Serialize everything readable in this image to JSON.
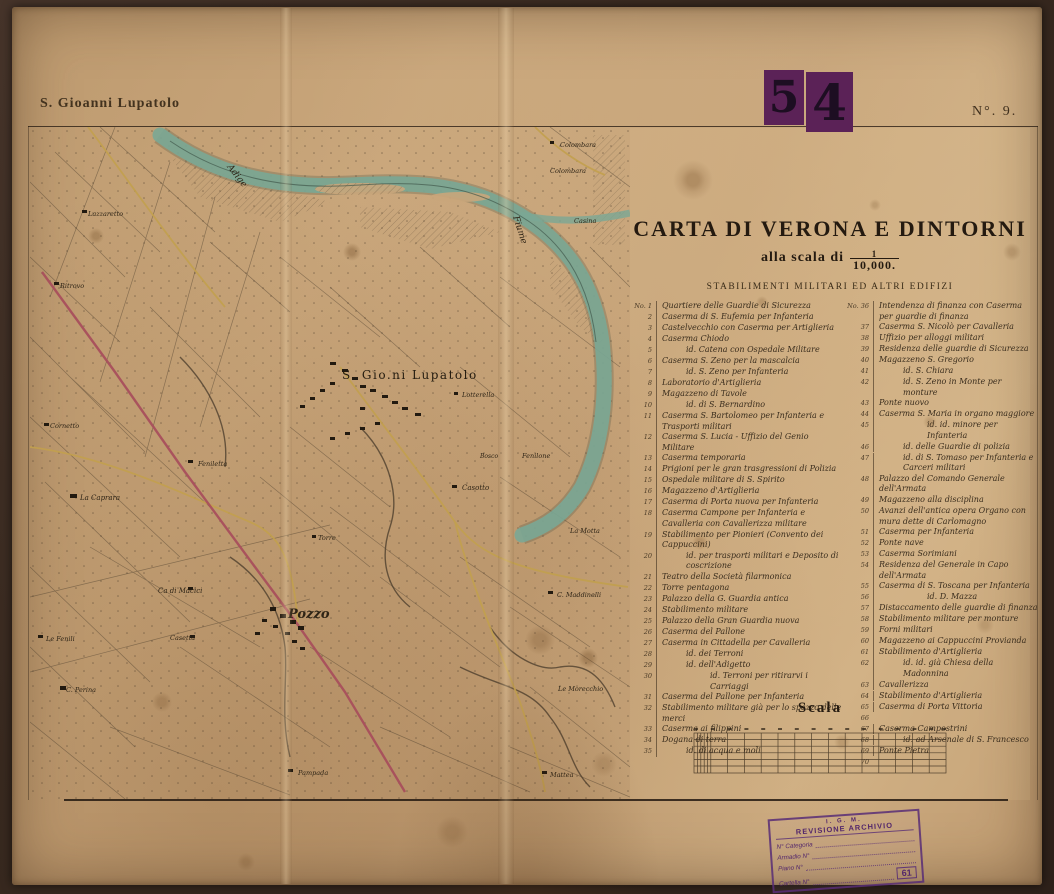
{
  "sheet": {
    "margin_title": "S. Gioanni Lupatolo",
    "sheet_number_left_digit": "5",
    "sheet_number_right_digit": "4",
    "sheet_no": "N°. 9."
  },
  "title_block": {
    "title": "CARTA DI VERONA E DINTORNI",
    "scale_prefix": "alla scala di",
    "scale_num": "1",
    "scale_den": "10,000.",
    "subtitle": "STABILIMENTI MILITARI ED ALTRI EDIFIZI"
  },
  "legend": {
    "left": [
      {
        "n": "No. 1",
        "t": "Quartiere delle Guardie di Sicurezza"
      },
      {
        "n": "2",
        "t": "Caserma di S. Eufemia per Infanteria"
      },
      {
        "n": "3",
        "t": "Castelvecchio con Caserma per Artiglieria"
      },
      {
        "n": "4",
        "t": "Caserma Chiodo"
      },
      {
        "n": "5",
        "t": "id. Catena con Ospedale Militare",
        "ind": 1
      },
      {
        "n": "6",
        "t": "Caserma S. Zeno per la mascalcia"
      },
      {
        "n": "7",
        "t": "id. S. Zeno per Infanteria",
        "ind": 1
      },
      {
        "n": "8",
        "t": "Laboratorio d'Artiglieria"
      },
      {
        "n": "9",
        "t": "Magazzeno di Tavole"
      },
      {
        "n": "10",
        "t": "id. di S. Bernardino",
        "ind": 1
      },
      {
        "n": "11",
        "t": "Caserma S. Bartolomeo per Infanteria e Trasporti militari"
      },
      {
        "n": "12",
        "t": "Caserma S. Lucia - Uffizio del Genio Militare"
      },
      {
        "n": "13",
        "t": "Caserma temporaria"
      },
      {
        "n": "14",
        "t": "Prigioni per le gran trasgressioni di Polizia"
      },
      {
        "n": "15",
        "t": "Ospedale militare di S. Spirito"
      },
      {
        "n": "16",
        "t": "Magazzeno d'Artiglieria"
      },
      {
        "n": "17",
        "t": "Caserma di Porta nuova per Infanteria"
      },
      {
        "n": "18",
        "t": "Caserma Campone per Infanteria e Cavalleria con Cavallerizza militare"
      },
      {
        "n": "19",
        "t": "Stabilimento per Pionieri (Convento dei Cappuccini)"
      },
      {
        "n": "20",
        "t": "id. per trasporti militari e Deposito di coscrizione",
        "ind": 1
      },
      {
        "n": "21",
        "t": "Teatro della Società filarmonica"
      },
      {
        "n": "22",
        "t": "Torre pentagona"
      },
      {
        "n": "23",
        "t": "Palazzo della G. Guardia antica"
      },
      {
        "n": "24",
        "t": "Stabilimento militare"
      },
      {
        "n": "25",
        "t": "Palazzo della Gran Guardia nuova"
      },
      {
        "n": "26",
        "t": "Caserma del Pallone"
      },
      {
        "n": "27",
        "t": "Caserma in Cittadella per Cavalleria"
      },
      {
        "n": "28",
        "t": "id. dei Terroni",
        "ind": 1
      },
      {
        "n": "29",
        "t": "id. dell'Adigetto",
        "ind": 1
      },
      {
        "n": "30",
        "t": "id. Terroni per ritirarvi i Carriaggi",
        "ind": 2
      },
      {
        "n": "31",
        "t": "Caserma del Pallone per Infanteria"
      },
      {
        "n": "32",
        "t": "Stabilimento militare già per lo spazzo delle merci"
      },
      {
        "n": "33",
        "t": "Caserma ai filippini"
      },
      {
        "n": "34",
        "t": "Dogana di terra"
      },
      {
        "n": "35",
        "t": "id. di acqua e moli",
        "ind": 1
      }
    ],
    "right": [
      {
        "n": "No. 36",
        "t": "Intendenza di finanza con Caserma per guardie di finanza"
      },
      {
        "n": "37",
        "t": "Caserma S. Nicolò per Cavalleria"
      },
      {
        "n": "38",
        "t": "Uffizio per alloggi militari"
      },
      {
        "n": "39",
        "t": "Residenza delle guardie di Sicurezza"
      },
      {
        "n": "40",
        "t": "Magazzeno S. Gregorio"
      },
      {
        "n": "41",
        "t": "id. S. Chiara",
        "ind": 1
      },
      {
        "n": "42",
        "t": "id. S. Zeno in Monte per monture",
        "ind": 1
      },
      {
        "n": "43",
        "t": "Ponte nuovo"
      },
      {
        "n": "44",
        "t": "Caserma S. Maria in organo maggiore"
      },
      {
        "n": "45",
        "t": "id. id. minore per Infanteria",
        "ind": 2
      },
      {
        "n": "46",
        "t": "id. delle Guardie di polizia",
        "ind": 1
      },
      {
        "n": "47",
        "t": "id. di S. Tomaso per Infanteria e Carceri militari",
        "ind": 1
      },
      {
        "n": "48",
        "t": "Palazzo del Comando Generale dell'Armata"
      },
      {
        "n": "49",
        "t": "Magazzeno alla disciplina"
      },
      {
        "n": "50",
        "t": "Avanzi dell'antica opera Organo con mura dette di Carlomagno"
      },
      {
        "n": "51",
        "t": "Caserma per Infanteria"
      },
      {
        "n": "52",
        "t": "Ponte nave"
      },
      {
        "n": "53",
        "t": "Caserma Sorimiani"
      },
      {
        "n": "54",
        "t": "Residenza del Generale in Capo dell'Armata"
      },
      {
        "n": "55",
        "t": "Caserma di S. Toscana per Infanteria"
      },
      {
        "n": "56",
        "t": "id. D. Mazza",
        "ind": 2
      },
      {
        "n": "57",
        "t": "Distaccamento delle guardie di finanza"
      },
      {
        "n": "58",
        "t": "Stabilimento militare per monture"
      },
      {
        "n": "59",
        "t": "Forni militari"
      },
      {
        "n": "60",
        "t": "Magazzeno ai Cappuccini Provianda"
      },
      {
        "n": "61",
        "t": "Stabilimento d'Artiglieria"
      },
      {
        "n": "62",
        "t": "id. id. già Chiesa della Madonnina",
        "ind": 1
      },
      {
        "n": "63",
        "t": "Cavallerizza"
      },
      {
        "n": "64",
        "t": "Stabilimento d'Artiglieria"
      },
      {
        "n": "65",
        "t": "Caserma di Porta Vittoria"
      },
      {
        "n": "66",
        "t": ""
      },
      {
        "n": "67",
        "t": "Caserma Campostrini"
      },
      {
        "n": "68",
        "t": "id. ad Arsenale di S. Francesco",
        "ind": 1
      },
      {
        "n": "69",
        "t": "Ponte Pietra"
      },
      {
        "n": "70",
        "t": ""
      }
    ]
  },
  "scale_bar": {
    "label": "Scala"
  },
  "stamp": {
    "org": "I. G. M.",
    "title": "REVISIONE ARCHIVIO",
    "fields": [
      {
        "label": "N° Categoria"
      },
      {
        "label": "Armadio N°"
      },
      {
        "label": "Piano N°"
      },
      {
        "label": "Cartella N°"
      }
    ],
    "number": "61"
  },
  "map": {
    "river_color": "#7aa795",
    "road_red": "#a84f5c",
    "road_yellow": "#c2a04e",
    "labels": [
      {
        "text": "Adige",
        "x": 197,
        "y": 40,
        "size": 9,
        "rot": 52
      },
      {
        "text": "Fiume",
        "x": 483,
        "y": 90,
        "size": 9,
        "rot": 72
      },
      {
        "text": "Colombara",
        "x": 530,
        "y": 20,
        "size": 6.5
      },
      {
        "text": "Colombara",
        "x": 520,
        "y": 46,
        "size": 6.5
      },
      {
        "text": "Casina",
        "x": 544,
        "y": 96,
        "size": 6.5
      },
      {
        "text": "S. Gio.ni Lupatolo",
        "x": 312,
        "y": 252,
        "size": 12,
        "u": 1
      },
      {
        "text": "Lotterella",
        "x": 432,
        "y": 270,
        "size": 6.5
      },
      {
        "text": "Bosco",
        "x": 450,
        "y": 331,
        "size": 6
      },
      {
        "text": "Fenilone",
        "x": 492,
        "y": 331,
        "size": 6.5
      },
      {
        "text": "Casotto",
        "x": 432,
        "y": 363,
        "size": 7
      },
      {
        "text": "La Motta",
        "x": 540,
        "y": 406,
        "size": 6.5
      },
      {
        "text": "C. Maddinelli",
        "x": 527,
        "y": 470,
        "size": 6.5
      },
      {
        "text": "Le Morecchio",
        "x": 528,
        "y": 564,
        "size": 6.5
      },
      {
        "text": "Mattea",
        "x": 520,
        "y": 650,
        "size": 6.5
      },
      {
        "text": "Pampada",
        "x": 268,
        "y": 648,
        "size": 6.5
      },
      {
        "text": "Pozzo",
        "x": 258,
        "y": 491,
        "size": 13,
        "b": 1
      },
      {
        "text": "Ca di Macici",
        "x": 128,
        "y": 466,
        "size": 7
      },
      {
        "text": "Torre",
        "x": 288,
        "y": 413,
        "size": 6.5
      },
      {
        "text": "Feniletta",
        "x": 168,
        "y": 339,
        "size": 6.5
      },
      {
        "text": "La Caprara",
        "x": 50,
        "y": 373,
        "size": 7
      },
      {
        "text": "Cornetto",
        "x": 20,
        "y": 301,
        "size": 6.5
      },
      {
        "text": "Lazzaretto",
        "x": 58,
        "y": 89,
        "size": 6.5
      },
      {
        "text": "Ritrovo",
        "x": 30,
        "y": 161,
        "size": 6.5
      },
      {
        "text": "Le Fenili",
        "x": 16,
        "y": 514,
        "size": 6.5
      },
      {
        "text": "Casetta",
        "x": 140,
        "y": 513,
        "size": 6.5
      },
      {
        "text": "C. Perina",
        "x": 36,
        "y": 565,
        "size": 6.5
      }
    ]
  },
  "colors": {
    "paper": "#c6a27a",
    "frame": "#3a2b22",
    "ink": "#3a2d1d",
    "river": "#7aa795",
    "road_red": "#a84f5c",
    "road_yellow": "#c2a04e",
    "stamp_purple": "#5b2257",
    "stamp_ink": "#53276b"
  }
}
